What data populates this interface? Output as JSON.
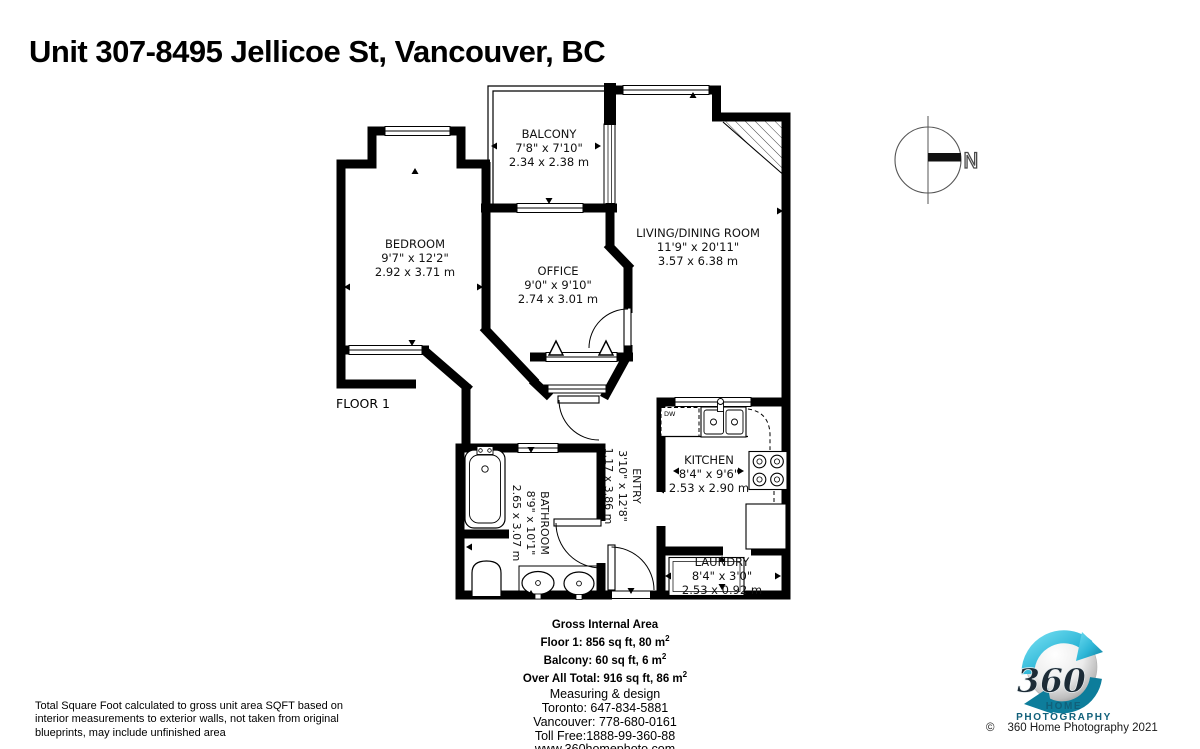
{
  "title": "Unit 307-8495 Jellicoe St, Vancouver, BC",
  "floor_label": "FLOOR 1",
  "compass_label": "N",
  "labels": {
    "dw": "DW"
  },
  "rooms": {
    "balcony": {
      "name": "BALCONY",
      "imperial": "7'8\" x 7'10\"",
      "metric": "2.34 x 2.38 m"
    },
    "bedroom": {
      "name": "BEDROOM",
      "imperial": "9'7\" x 12'2\"",
      "metric": "2.92 x 3.71 m"
    },
    "office": {
      "name": "OFFICE",
      "imperial": "9'0\" x 9'10\"",
      "metric": "2.74 x 3.01 m"
    },
    "living_dining": {
      "name": "LIVING/DINING ROOM",
      "imperial": "11'9\" x 20'11\"",
      "metric": "3.57 x 6.38 m"
    },
    "kitchen": {
      "name": "KITCHEN",
      "imperial": "8'4\" x 9'6\"",
      "metric": "2.53 x 2.90 m"
    },
    "entry": {
      "name": "ENTRY",
      "imperial": "3'10\" x 12'8\"",
      "metric": "1.17 x 3.86 m"
    },
    "bathroom": {
      "name": "BATHROOM",
      "imperial": "8'9\" x 10'1\"",
      "metric": "2.65 x 3.07 m"
    },
    "laundry": {
      "name": "LAUNDRY",
      "imperial": "8'4\" x 3'0\"",
      "metric": "2.53 x 0.92 m"
    }
  },
  "area_summary": {
    "title": "Gross Internal Area",
    "floor1": {
      "text": "Floor 1: 856 sq ft, 80 m",
      "sup": "2"
    },
    "balcony": {
      "text": "Balcony: 60 sq ft, 6 m",
      "sup": "2"
    },
    "total": {
      "text": "Over All Total: 916 sq ft, 86 m",
      "sup": "2"
    }
  },
  "contact": {
    "line1": "Measuring & design",
    "line2": "Toronto: 647-834-5881",
    "line3": "Vancouver: 778-680-0161",
    "line4": "Toll Free:1888-99-360-88",
    "website": "www.360homephoto.com"
  },
  "disclaimer": "Total Square Foot calculated to gross unit area SQFT based on interior measurements to exterior walls, not taken from original blueprints, may include unfinished area",
  "logo": {
    "number": "360",
    "brand": "HOME PHOTOGRAPHY",
    "copyright_symbol": "©",
    "copyright_text": "360 Home Photography 2021"
  },
  "colors": {
    "wall": "#000000",
    "logo_teal": "#2cb5d6",
    "logo_teal_dark": "#0d7d9b",
    "brand_text": "#11607a"
  }
}
